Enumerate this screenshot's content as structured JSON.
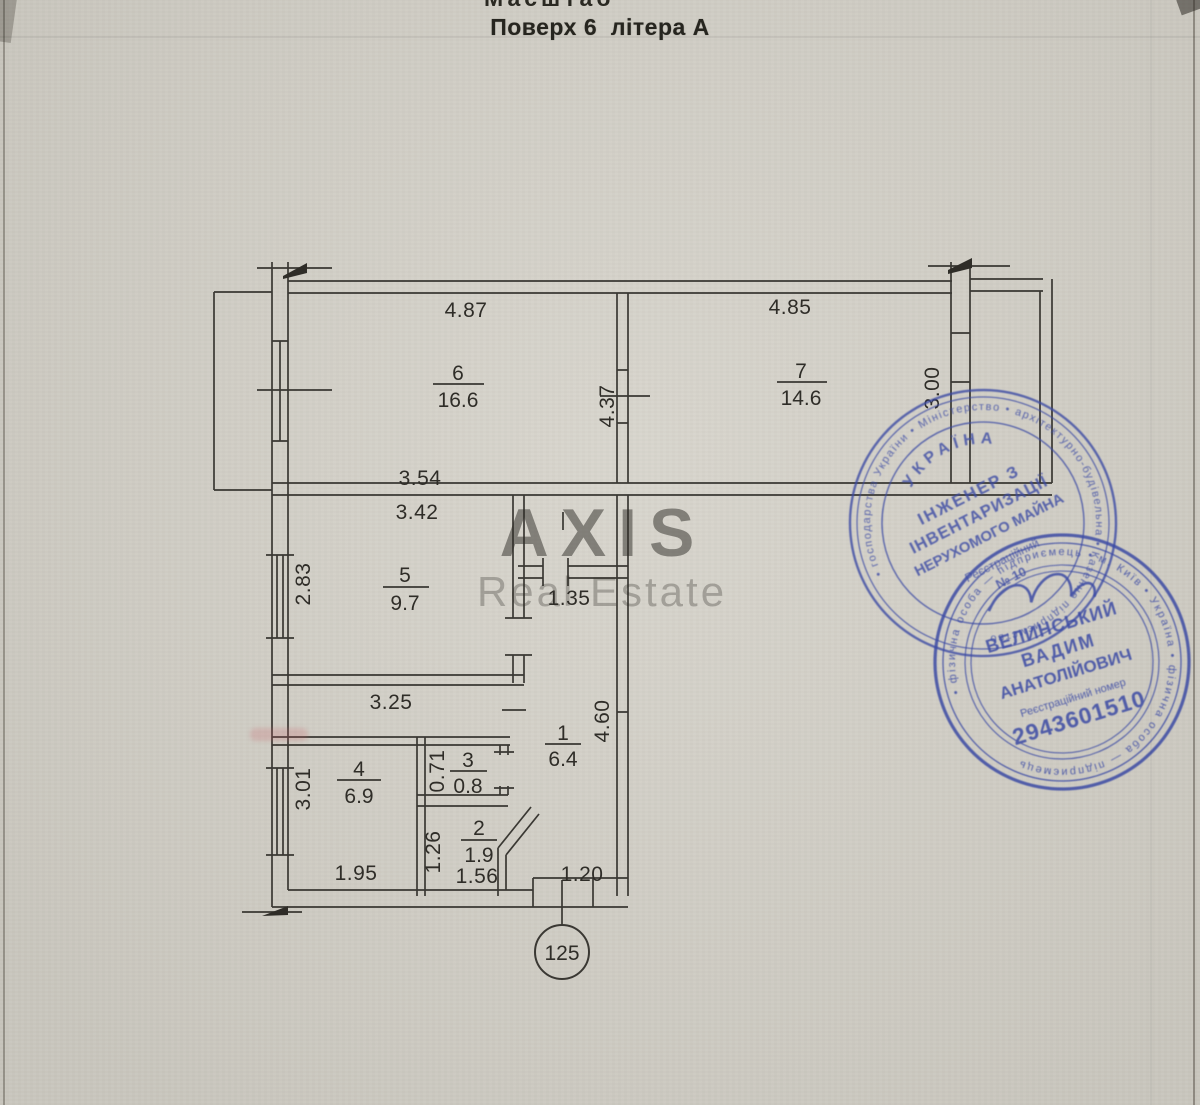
{
  "document": {
    "cropped_top_text": "Масштаб",
    "title": "Поверх 6  літера А",
    "unit_number": "125"
  },
  "watermark": {
    "line1": "AXIS",
    "line2": "Real Estate"
  },
  "rooms": {
    "r1": {
      "number": "1",
      "area": "6.4"
    },
    "r2": {
      "number": "2",
      "area": "1.9"
    },
    "r3": {
      "number": "3",
      "area": "0.8"
    },
    "r4": {
      "number": "4",
      "area": "6.9"
    },
    "r5": {
      "number": "5",
      "area": "9.7"
    },
    "r6": {
      "number": "6",
      "area": "16.6"
    },
    "r7": {
      "number": "7",
      "area": "14.6"
    }
  },
  "dimensions": {
    "room6_top": "4.87",
    "room7_top": "4.85",
    "rooms67_depth": "4.37",
    "room7_right": "3.00",
    "room5_outer": "3.54",
    "room5_top": "3.42",
    "room5_left": "2.83",
    "hall_top": "1.35",
    "band_bottom": "3.25",
    "hall_right": "4.60",
    "room4_left": "3.01",
    "room4_bottom": "1.95",
    "wc_left": "0.71",
    "bath_left": "1.26",
    "bath_bottom": "1.56",
    "entry_bottom": "1.20"
  },
  "stamps": {
    "engineer": {
      "ring_text": "• господарства України • Міністерство • архітектурно-будівельна • Казенне підприємство",
      "country": "УКРАЇНА",
      "title_line1": "ІНЖЕНЕР З",
      "title_line2": "ІНВЕНТАРИЗАЦІЇ",
      "title_line3": "НЕРУХОМОГО МАЙНА",
      "reg_label": "Реєстраційний",
      "reg_no": "№ 10"
    },
    "person": {
      "ring_text": "• фізична особа — підприємець • м. Київ • Україна • фізична особа — підприємець",
      "surname": "ВЕЛИНСЬКИЙ",
      "first_name": "ВАДИМ",
      "patronymic": "АНАТОЛІЙОВИЧ",
      "reg_label": "Реєстраційний номер",
      "reg_number": "2943601510"
    }
  },
  "colors": {
    "paper": "#d4d1c8",
    "ink": "#3a3833",
    "stamp_blue": "#3b4aa4"
  }
}
